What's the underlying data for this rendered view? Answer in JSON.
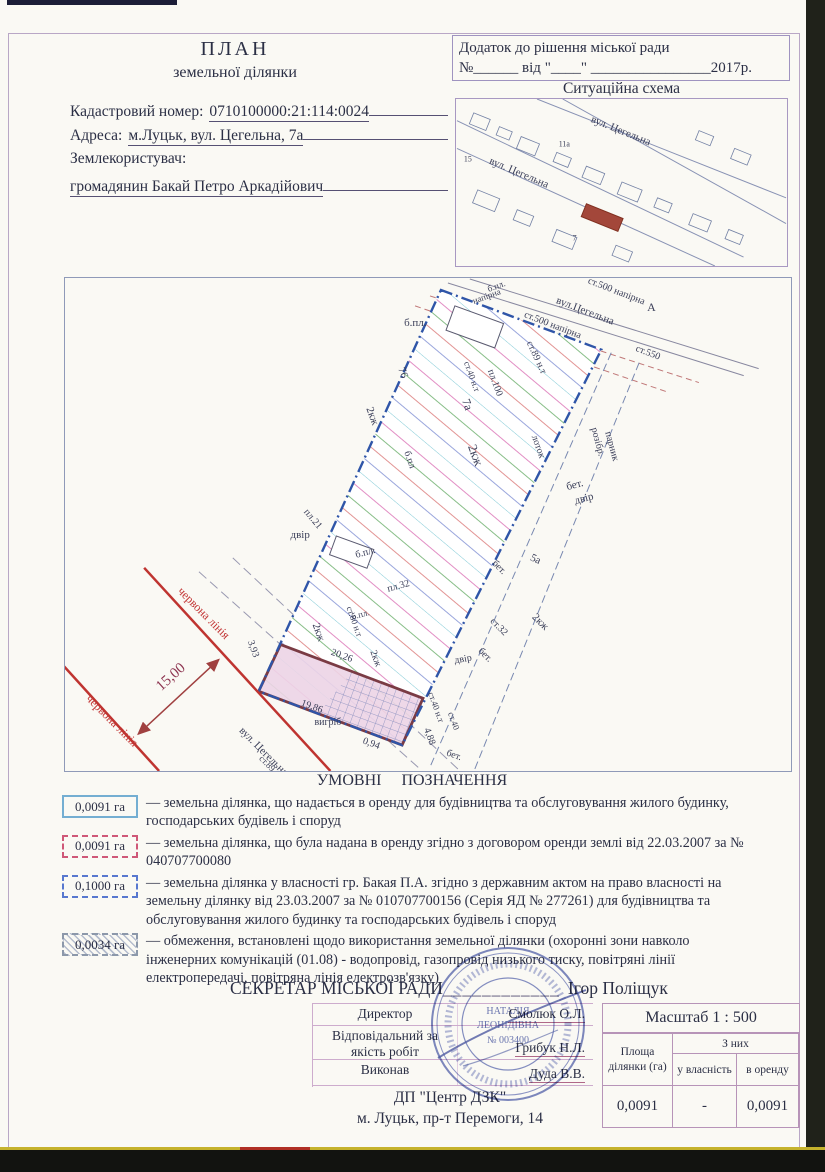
{
  "document": {
    "title1": "ПЛАН",
    "title2": "земельної ділянки",
    "cadastral_label": "Кадастровий номер:",
    "cadastral_value": "0710100000:21:114:0024",
    "address_label": "Адреса:",
    "address_value": "м.Луцьк, вул. Цегельна, 7а",
    "landuser_label": "Землекористувач:",
    "landuser_value": "громадянин Бакай Петро Аркадійович"
  },
  "annex": {
    "line1": "Додаток до рішення міської ради",
    "line2": "№______ від \"____\" ________________2017р."
  },
  "situation": {
    "title": "Ситуаційна схема",
    "labels": [
      {
        "t": "вул. Цегельна",
        "x": 590,
        "y": 121,
        "r": 22,
        "s": 11
      },
      {
        "t": "вул. Цегельна",
        "x": 487,
        "y": 163,
        "r": 23,
        "s": 11
      },
      {
        "t": "15",
        "x": 462,
        "y": 161,
        "r": 0,
        "s": 8
      },
      {
        "t": "11а",
        "x": 558,
        "y": 146,
        "r": 0,
        "s": 8
      },
      {
        "t": "7",
        "x": 572,
        "y": 241,
        "r": 0,
        "s": 8
      }
    ]
  },
  "plan": {
    "labels": [
      {
        "t": "б.пл.",
        "x": 404,
        "y": 325,
        "r": 0,
        "s": 11
      },
      {
        "t": "76",
        "x": 398,
        "y": 368,
        "r": 70,
        "s": 11
      },
      {
        "t": "2кж",
        "x": 366,
        "y": 408,
        "r": 70,
        "s": 11
      },
      {
        "t": "б.пл",
        "x": 404,
        "y": 452,
        "r": 70,
        "s": 10
      },
      {
        "t": "пл.21",
        "x": 303,
        "y": 512,
        "r": 50,
        "s": 10
      },
      {
        "t": "двір",
        "x": 290,
        "y": 538,
        "r": 0,
        "s": 11
      },
      {
        "t": "б.пл.",
        "x": 356,
        "y": 558,
        "r": -15,
        "s": 10
      },
      {
        "t": "пл.32",
        "x": 388,
        "y": 592,
        "r": -15,
        "s": 10
      },
      {
        "t": "2кж",
        "x": 312,
        "y": 625,
        "r": 70,
        "s": 11
      },
      {
        "t": "2кж",
        "x": 468,
        "y": 446,
        "r": 70,
        "s": 13
      },
      {
        "t": "7а",
        "x": 462,
        "y": 400,
        "r": 70,
        "s": 12
      },
      {
        "t": "пл.100",
        "x": 488,
        "y": 370,
        "r": 70,
        "s": 10
      },
      {
        "t": "ст.40 н.т",
        "x": 464,
        "y": 362,
        "r": 70,
        "s": 9
      },
      {
        "t": "ст.89 н.т",
        "x": 527,
        "y": 342,
        "r": 65,
        "s": 10
      },
      {
        "t": "лоток",
        "x": 532,
        "y": 436,
        "r": 70,
        "s": 10
      },
      {
        "t": "б.пл.",
        "x": 489,
        "y": 291,
        "r": -20,
        "s": 9
      },
      {
        "t": "напірна",
        "x": 474,
        "y": 303,
        "r": -20,
        "s": 9
      },
      {
        "t": "вул.Цегельна",
        "x": 556,
        "y": 302,
        "r": 21,
        "s": 11
      },
      {
        "t": "ст.500 напірна",
        "x": 588,
        "y": 282,
        "r": 21,
        "s": 10
      },
      {
        "t": "ст.500 напірна",
        "x": 524,
        "y": 316,
        "r": 21,
        "s": 10
      },
      {
        "t": "А",
        "x": 648,
        "y": 310,
        "r": 0,
        "s": 12
      },
      {
        "t": "ст.550",
        "x": 636,
        "y": 350,
        "r": 21,
        "s": 10
      },
      {
        "t": "розібр.",
        "x": 592,
        "y": 428,
        "r": 75,
        "s": 10
      },
      {
        "t": "парник",
        "x": 606,
        "y": 432,
        "r": 75,
        "s": 10
      },
      {
        "t": "бет.",
        "x": 568,
        "y": 490,
        "r": -15,
        "s": 11
      },
      {
        "t": "двір",
        "x": 576,
        "y": 504,
        "r": -15,
        "s": 11
      },
      {
        "t": "3,93",
        "x": 247,
        "y": 642,
        "r": 70,
        "s": 10
      },
      {
        "t": "20,26",
        "x": 330,
        "y": 655,
        "r": 20,
        "s": 10
      },
      {
        "t": "2кж",
        "x": 370,
        "y": 652,
        "r": 70,
        "s": 10
      },
      {
        "t": "б.пл.",
        "x": 352,
        "y": 620,
        "r": -15,
        "s": 9
      },
      {
        "t": "ст.80 н.т",
        "x": 346,
        "y": 608,
        "r": 70,
        "s": 9
      },
      {
        "t": "19,86",
        "x": 300,
        "y": 706,
        "r": 20,
        "s": 10
      },
      {
        "t": "вигріб",
        "x": 314,
        "y": 726,
        "r": 0,
        "s": 10
      },
      {
        "t": "0,94",
        "x": 362,
        "y": 744,
        "r": 20,
        "s": 10
      },
      {
        "t": "4,88",
        "x": 424,
        "y": 730,
        "r": 70,
        "s": 10
      },
      {
        "t": "бет.",
        "x": 446,
        "y": 756,
        "r": 20,
        "s": 10
      },
      {
        "t": "ст.40 н.т",
        "x": 428,
        "y": 694,
        "r": 70,
        "s": 9
      },
      {
        "t": "ст.40",
        "x": 448,
        "y": 714,
        "r": 70,
        "s": 9
      },
      {
        "t": "двір",
        "x": 455,
        "y": 664,
        "r": -10,
        "s": 10
      },
      {
        "t": "бет.",
        "x": 478,
        "y": 652,
        "r": 45,
        "s": 10
      },
      {
        "t": "ст.32",
        "x": 490,
        "y": 622,
        "r": 45,
        "s": 10
      },
      {
        "t": "2кж",
        "x": 532,
        "y": 618,
        "r": 45,
        "s": 11
      },
      {
        "t": "бет.",
        "x": 492,
        "y": 564,
        "r": 45,
        "s": 10
      },
      {
        "t": "5а",
        "x": 530,
        "y": 560,
        "r": 25,
        "s": 11
      },
      {
        "t": "15,00",
        "x": 160,
        "y": 692,
        "r": -42,
        "s": 15,
        "c": "#8d3450"
      },
      {
        "t": "червона лінія",
        "x": 176,
        "y": 592,
        "r": 45,
        "s": 12,
        "c": "#c23434"
      },
      {
        "t": "червона лінія",
        "x": 84,
        "y": 700,
        "r": 45,
        "s": 12,
        "c": "#c23434"
      },
      {
        "t": "вул. Цегельна",
        "x": 238,
        "y": 732,
        "r": 45,
        "s": 11
      },
      {
        "t": "ст.89 п.т",
        "x": 258,
        "y": 760,
        "r": 45,
        "s": 9
      }
    ]
  },
  "legend": {
    "title": "УМОВНІ   ПОЗНАЧЕННЯ",
    "items": [
      {
        "area": "0,0091 га",
        "text": "— земельна ділянка, що надається в оренду для будівництва та обслуговування жилого будинку, господарських будівель і споруд"
      },
      {
        "area": "0,0091 га",
        "text": "— земельна ділянка, що була надана в оренду згідно з договором оренди землі від 22.03.2007 за № 040707700080"
      },
      {
        "area": "0,1000 га",
        "text": "— земельна ділянка у власності гр. Бакая П.А. згідно з державним  актом на право власності на земельну ділянку від 23.03.2007 за №  010707700156 (Серія ЯД №  277261) для будівництва та обслуговування жилого будинку та господарських будівель і споруд"
      },
      {
        "area": "0,0034 га",
        "text": "— обмеження, встановлені щодо використання земельної ділянки (охоронні зони навколо інженерних комунікацій (01.08) - водопровід, газопровід низького тиску, повітряні лінії електропередачі, повітряна лінія електрозв'язку)"
      }
    ]
  },
  "signoff": {
    "secretary_label": "СЕКРЕТАР МІСЬКОЇ РАДИ",
    "underline": "____________",
    "secretary_name": "Ігор Поліщук",
    "rows": [
      {
        "role": "Директор",
        "name": "Смолюк О.Л."
      },
      {
        "role": "Відповідальний за якість робіт",
        "name": "Грибук Н.Л."
      },
      {
        "role": "Виконав",
        "name": "Дуда В.В."
      }
    ],
    "org": "ДП \"Центр ДЗК\"",
    "org_address": "м. Луцьк, пр-т Перемоги, 14"
  },
  "scale": {
    "label": "Масштаб  1 : 500"
  },
  "area_table": {
    "col1": "Площа ділянки (га)",
    "group": "З них",
    "col2": "у власність",
    "col3": "в оренду",
    "values": [
      "0,0091",
      "-",
      "0,0091"
    ]
  },
  "stamp": {
    "line1": "НАТАЛІЯ",
    "line2": "ЛЕОНІДІВНА",
    "line3": "№ 003400"
  }
}
